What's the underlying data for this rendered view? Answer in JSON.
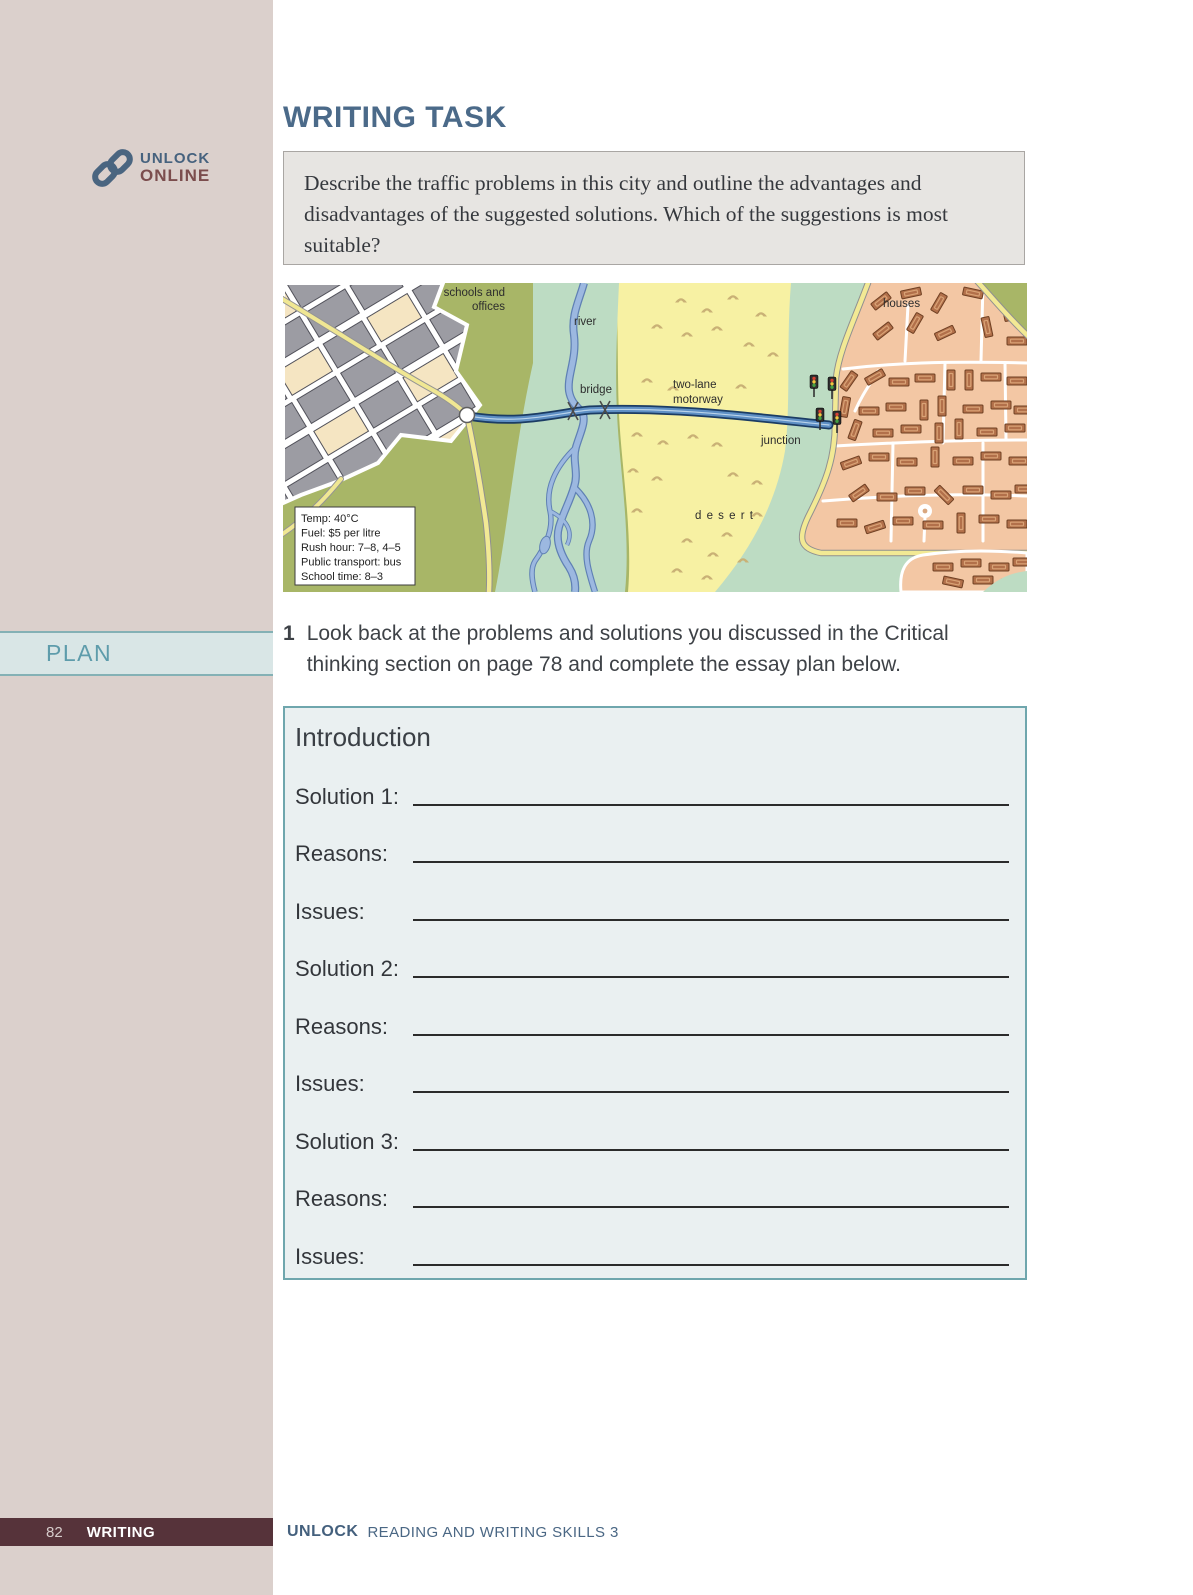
{
  "sidebar": {
    "brand_top": "UNLOCK",
    "brand_bottom": "ONLINE",
    "plan_label": "PLAN"
  },
  "header": {
    "title": "WRITING TASK"
  },
  "task": {
    "text": "Describe the traffic problems in this city and outline the advantages and disadvantages of the suggested solutions. Which of the suggestions is most suitable?"
  },
  "map": {
    "labels": {
      "schools_line1": "schools and",
      "schools_line2": "offices",
      "river": "river",
      "bridge": "bridge",
      "motorway_line1": "two-lane",
      "motorway_line2": "motorway",
      "junction": "junction",
      "houses": "houses",
      "desert": "d e s e r t"
    },
    "info": [
      "Temp: 40°C",
      "Fuel: $5 per litre",
      "Rush hour: 7–8,  4–5",
      "Public transport: bus",
      "School time: 8–3"
    ]
  },
  "instruction": {
    "number": "1",
    "text": "Look back at the problems and solutions you discussed in the Critical thinking section on page 78 and complete the essay plan below."
  },
  "plan": {
    "title": "Introduction",
    "rows": [
      "Solution 1:",
      "Reasons:",
      "Issues:",
      "Solution 2:",
      "Reasons:",
      "Issues:",
      "Solution 3:",
      "Reasons:",
      "Issues:"
    ]
  },
  "footer": {
    "page": "82",
    "section": "WRITING",
    "brand": "UNLOCK",
    "book": "READING AND WRITING SKILLS 3"
  },
  "colors": {
    "accent_teal": "#6fa6ad",
    "heading_blue": "#4b6a89",
    "footer_maroon": "#56333a",
    "sidebar_pink": "#dbd0cc"
  }
}
